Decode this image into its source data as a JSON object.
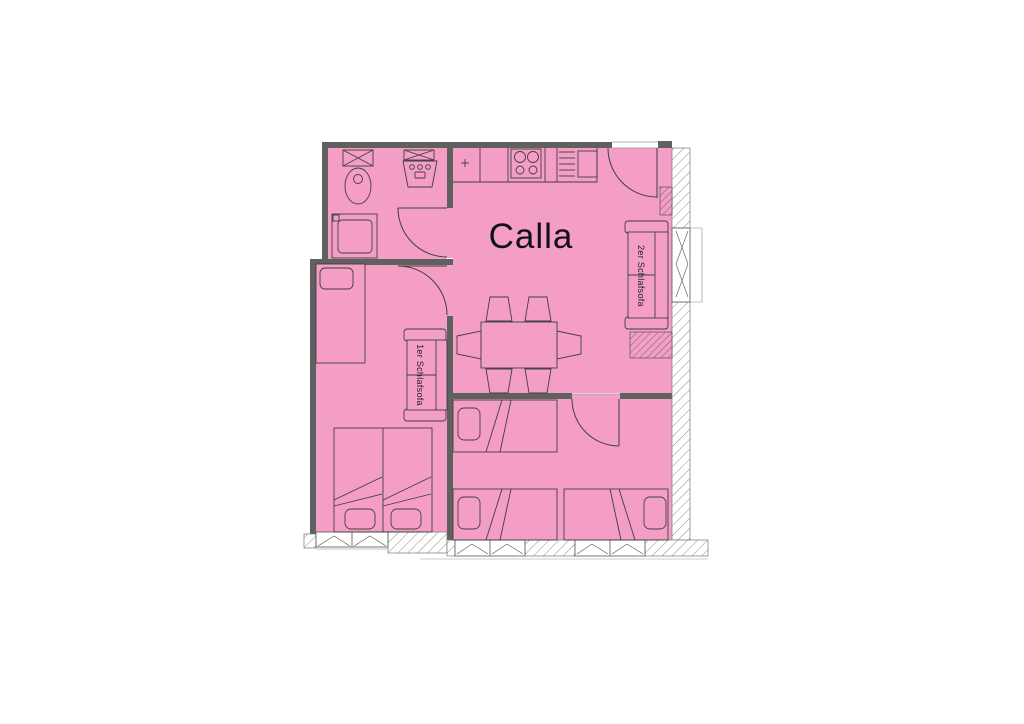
{
  "floorplan": {
    "living_room_label": "Calla",
    "sofa_double_label": "2er Schlafsofa",
    "sofa_single_label": "1er Schlafsofa",
    "colors": {
      "room_fill": "#F49EC6",
      "wall": "#606060",
      "furniture_line": "#3F3F3F"
    }
  }
}
